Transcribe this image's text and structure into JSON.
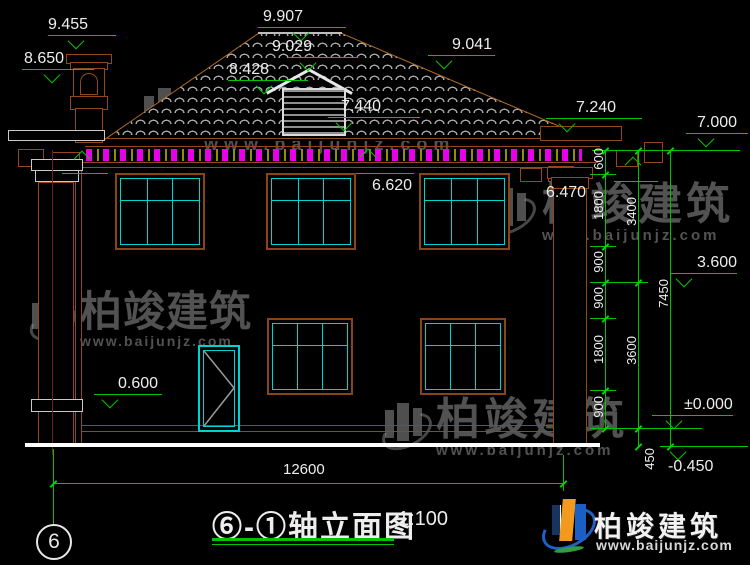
{
  "title": {
    "name": "⑥-①轴立面图",
    "scale": "1:100"
  },
  "axis": {
    "bubble": "6"
  },
  "elevations": [
    {
      "label": "9.455"
    },
    {
      "label": "8.650"
    },
    {
      "label": "9.907"
    },
    {
      "label": "9.029"
    },
    {
      "label": "8.428"
    },
    {
      "label": "7.440"
    },
    {
      "label": "9.041"
    },
    {
      "label": "7.240"
    },
    {
      "label": "7.000"
    },
    {
      "label": "6.620"
    },
    {
      "label": "6.470"
    },
    {
      "label": "3.600"
    },
    {
      "label": "0.600"
    },
    {
      "label": "±0.000"
    },
    {
      "label": "-0.450"
    }
  ],
  "vertical_dims": {
    "chain1": [
      "600",
      "1800",
      "900",
      "900",
      "1800",
      "900"
    ],
    "chain2": [
      "3400",
      "3600",
      "450"
    ],
    "overall": "7450"
  },
  "horizontal_dims": {
    "overall": "12600"
  },
  "watermark": {
    "brand": "柏竣建筑",
    "url": "www.baijunjz.com"
  },
  "logo": {
    "brand": "柏竣建筑",
    "url": "www.baijunjz.com"
  },
  "colors": {
    "dimension_green": "#00c400",
    "window_cyan": "#00d2d2",
    "facade_brown": "#91481c",
    "dentil_magenta": "#e800e8",
    "tile_gray": "#a8a8a8",
    "ground_white": "#ffffff"
  }
}
